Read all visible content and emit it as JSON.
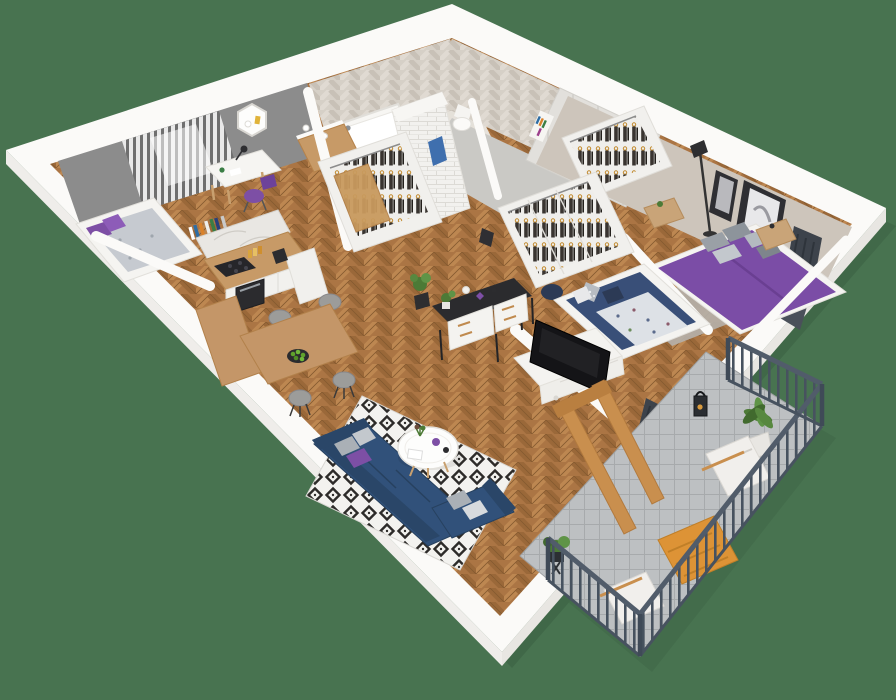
{
  "scene": {
    "title": "3D apartment floor plan cutaway render",
    "view": "isometric top-down",
    "background_color": "#487350",
    "rooms": [
      {
        "name": "Small bedroom",
        "wall_color": "#8c8c8c",
        "furniture": [
          "single bed with purple pillows and gray blanket",
          "white desk with lamp",
          "purple chair",
          "hexagonal wall shelf",
          "gray striped curtains",
          "row of books"
        ]
      },
      {
        "name": "Kitchen & dining",
        "furniture": [
          "white cabinets",
          "wood countertop",
          "black cooktop",
          "oven",
          "coffee machine",
          "marble half wall",
          "L-shaped wood dining bar",
          "4 gray chairs",
          "bowl of greens"
        ]
      },
      {
        "name": "Bathroom",
        "wall_finish": "beige herringbone tile",
        "furniture": [
          "bathtub",
          "white brick shower column",
          "wood vanity with sink",
          "toilet",
          "blue towel"
        ]
      },
      {
        "name": "Entrance hall",
        "furniture": [
          "floor-to-ceiling light gray wardrobes",
          "book niche",
          "concrete floor"
        ]
      },
      {
        "name": "Master bedroom",
        "wall_color": "#cdc5bb",
        "furniture": [
          "double bed with purple duvet",
          "gray pillows",
          "two wood nightstands",
          "open wardrobe with clothes",
          "two framed artworks",
          "floor lamp",
          "dark radiator",
          "gray rug",
          "leaning mirror"
        ]
      },
      {
        "name": "Kids room",
        "furniture": [
          "navy single bed with patterned blanket",
          "star pillow",
          "cube wardrobe with hanging clothes",
          "navy pouf",
          "dark radiator",
          "small wall frame"
        ]
      },
      {
        "name": "Living room",
        "furniture": [
          "navy corner sofa",
          "gray and purple cushions",
          "round white coffee table with purple vase",
          "black and white diamond rug",
          "black frame sideboard with white drawers",
          "white TV cabinet",
          "flat screen TV",
          "potted plant"
        ]
      },
      {
        "name": "Balcony",
        "floor": "gray tile",
        "furniture": [
          "dark metal railing",
          "two white lounge chairs",
          "orange slat table",
          "black lantern",
          "two potted plants",
          "wood glass door frames"
        ]
      }
    ],
    "palette": {
      "background_green": "#487350",
      "wall_white": "#fbfaf8",
      "wood_floor": "#ab7544",
      "accent_purple": "#7b4da6",
      "sofa_navy": "#31517a",
      "railing_gray": "#4a5562",
      "furniture_wood": "#c79a67",
      "orange_accent": "#dd9336",
      "plant_green": "#4c7a36",
      "rug_black": "#2d2b29",
      "rug_white": "#f3f2ef",
      "gray_wall": "#8c8c8c",
      "greige_wall": "#cdc5bb"
    }
  }
}
